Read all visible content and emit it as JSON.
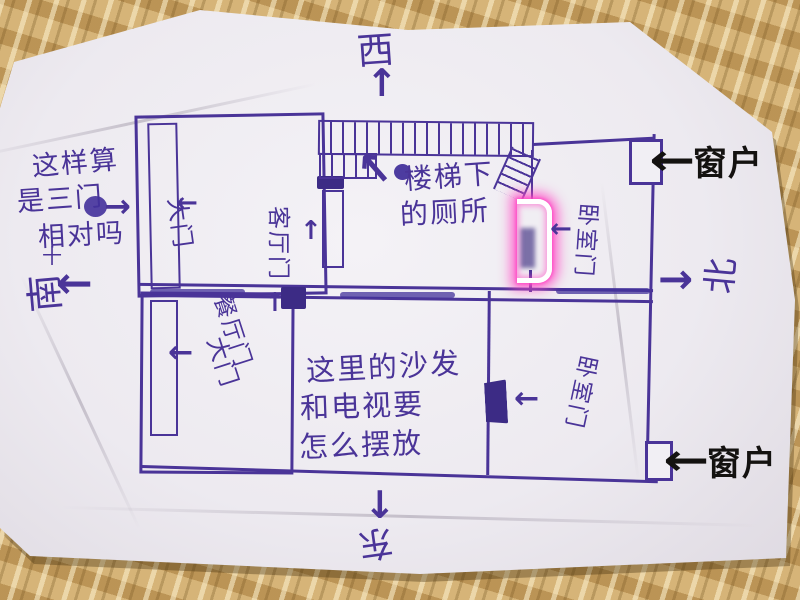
{
  "compass": {
    "west": "西",
    "south": "南",
    "north": "北",
    "east": "东",
    "south_tick": "十"
  },
  "notes": {
    "question_line1": "这样算",
    "question_line2": "是三门",
    "question_line3": "相对吗",
    "toilet_line1": "楼梯下",
    "toilet_line2": "的厕所",
    "sofa_line1": "这里的沙发",
    "sofa_line2": "和电视要",
    "sofa_line3": "怎么摆放"
  },
  "labels": {
    "window": "窗户",
    "living_door": "客厅门",
    "dining_door": "餐厅门",
    "main_door_upper": "大门",
    "main_door_lower": "大门",
    "bedroom_door_upper": "卧室门",
    "bedroom_door_lower": "卧室门"
  },
  "icons": {
    "arrow_left": "←",
    "arrow_right": "→",
    "arrow_up": "↑",
    "arrow_down": "↓",
    "arrow_up_left": "↖",
    "arrow_up_right": "↗"
  },
  "colors": {
    "pen": "#4a3498",
    "ink_black": "#141210",
    "highlight_pink": "#ff49c5",
    "paper": "#edeaf0",
    "mat": "#c49f63"
  }
}
